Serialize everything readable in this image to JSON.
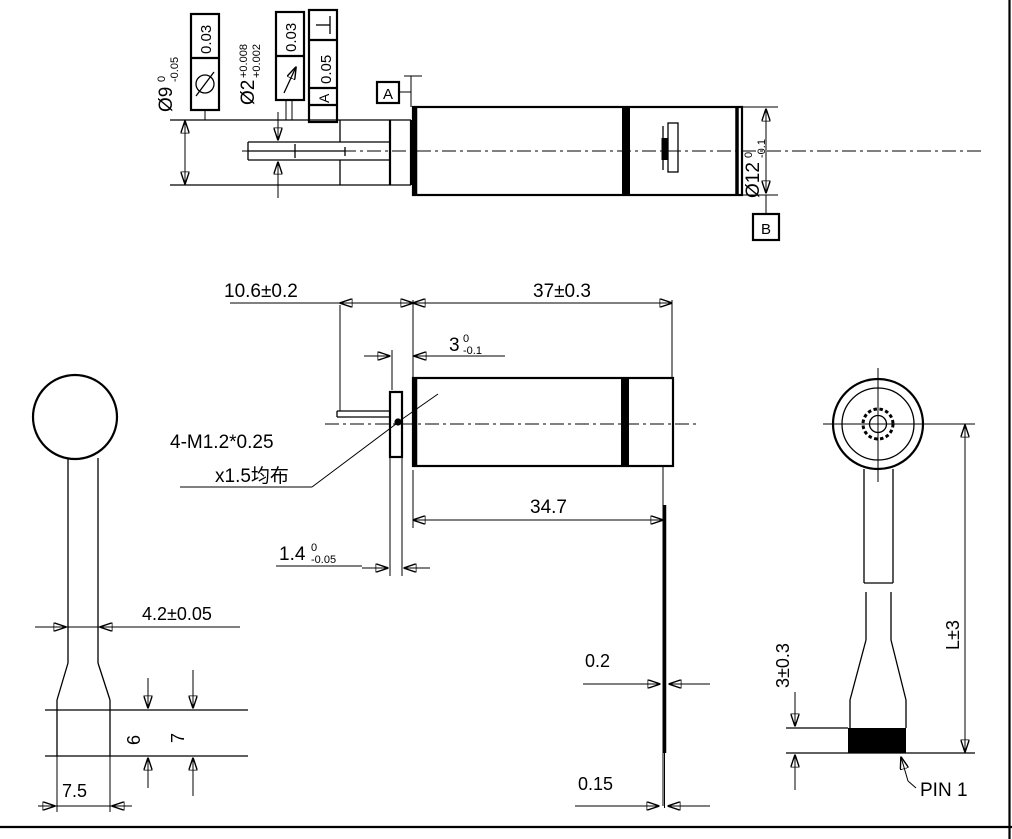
{
  "background": "#ffffff",
  "line_color": "#000000",
  "symbols": {
    "cylindricity_icon": "circle-with-slash",
    "circular_runout_icon": "diagonal-arrow",
    "perpendicularity_icon": "inverted-T"
  },
  "views": {
    "side_top": {
      "dia9": {
        "main": "Ø9",
        "sup": "0",
        "sub": "-0.05"
      },
      "dia2": {
        "main": "Ø2",
        "sup": "+0.008",
        "sub": "+0.002"
      },
      "dia12": {
        "main": "Ø12",
        "sup": "0",
        "sub": "-0.1"
      },
      "fcf_cylindricity": {
        "value": "0.03"
      },
      "fcf_runout": {
        "value": "0.03"
      },
      "fcf_perpendicularity": {
        "value": "0.05",
        "datum": "A"
      },
      "datum_a": "A",
      "datum_b": "B"
    },
    "side_main": {
      "gearhead_length": "10.6±0.2",
      "body_length": "37±0.3",
      "boss_length": {
        "main": "3",
        "sup": "0",
        "sub": "-0.1"
      },
      "case_length": "34.7",
      "plate_thickness": {
        "main": "1.4",
        "sup": "0",
        "sub": "-0.05"
      },
      "thread_note_line1": "4-M1.2*0.25",
      "thread_note_line2": "x1.5均布"
    },
    "front_left": {
      "shaft_flat_width": "4.2±0.05",
      "dim_6": "6",
      "dim_7": "7",
      "dim_7_5": "7.5"
    },
    "terminal": {
      "pin_thickness": "0.2",
      "pin_tip_thickness": "0.15"
    },
    "rear_right": {
      "block_height": "3±0.3",
      "lead_length": "L±3",
      "pin1_label": "PIN 1"
    }
  }
}
